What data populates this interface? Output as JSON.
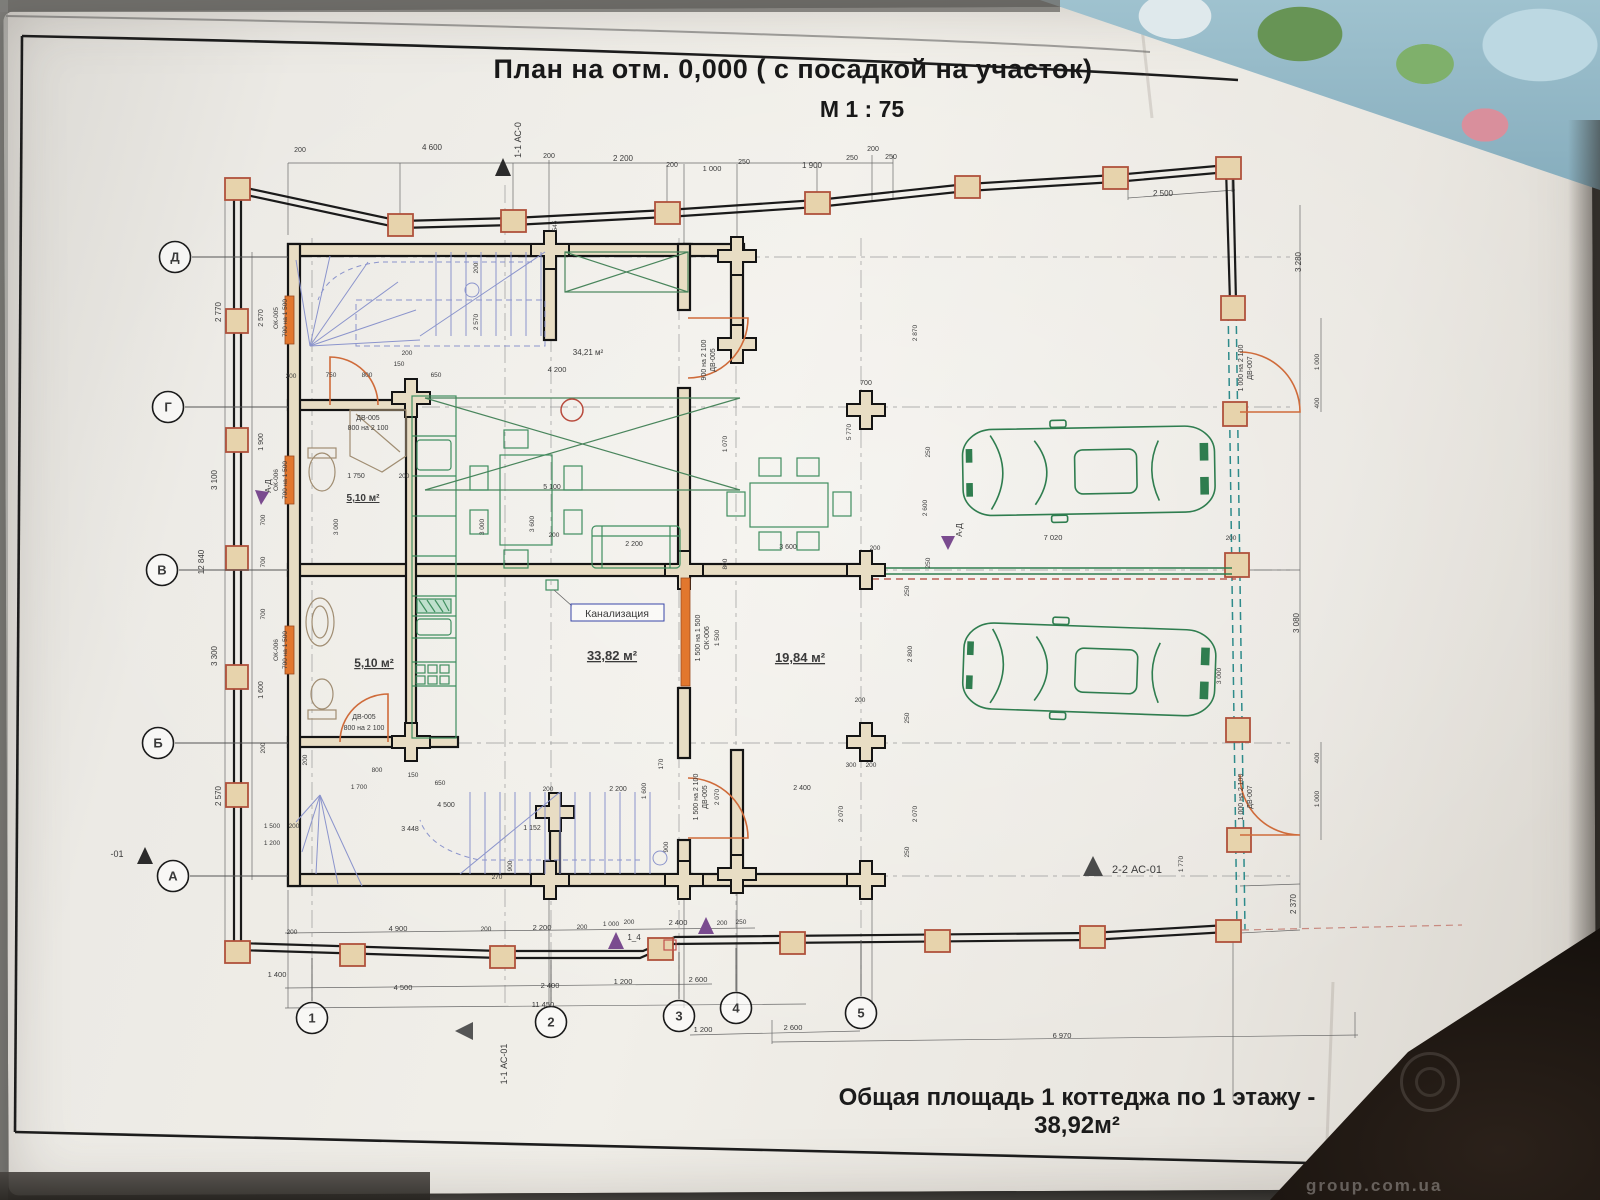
{
  "title": {
    "line1": "План на отм. 0,000 ( с посадкой на участок)",
    "line2": "М 1 : 75"
  },
  "footer": {
    "text": "Общая площадь 1 коттеджа по 1 этажу - 38,92м²"
  },
  "photo": {
    "watermark": "group.com.ua"
  },
  "colors": {
    "d": "#3a3a3a",
    "b": "#3946a8",
    "p": "#7a4b8f",
    "g": "#2f7d4f",
    "o": "#cf6b3a",
    "k": "#1a1a1a"
  },
  "grid": {
    "rows": [
      {
        "label": "Д",
        "x": 175,
        "y": 257
      },
      {
        "label": "Г",
        "x": 168,
        "y": 407
      },
      {
        "label": "В",
        "x": 162,
        "y": 570
      },
      {
        "label": "Б",
        "x": 158,
        "y": 743
      },
      {
        "label": "А",
        "x": 173,
        "y": 876
      }
    ],
    "cols": [
      {
        "label": "1",
        "x": 312,
        "y": 1018
      },
      {
        "label": "2",
        "x": 551,
        "y": 1022
      },
      {
        "label": "3",
        "x": 679,
        "y": 1016
      },
      {
        "label": "4",
        "x": 736,
        "y": 1008
      },
      {
        "label": "5",
        "x": 861,
        "y": 1013
      }
    ]
  },
  "plan": {
    "labels": [
      {
        "t": "200",
        "x": 300,
        "y": 152,
        "s": 7
      },
      {
        "t": "4 600",
        "x": 432,
        "y": 150
      },
      {
        "t": "200",
        "x": 549,
        "y": 158,
        "s": 7
      },
      {
        "t": "2 200",
        "x": 623,
        "y": 161
      },
      {
        "t": "200",
        "x": 672,
        "y": 167,
        "s": 7
      },
      {
        "t": "1 000",
        "x": 712,
        "y": 171,
        "s": 7.5
      },
      {
        "t": "250",
        "x": 744,
        "y": 164,
        "s": 7
      },
      {
        "t": "1 900",
        "x": 812,
        "y": 168
      },
      {
        "t": "250",
        "x": 852,
        "y": 160,
        "s": 7
      },
      {
        "t": "200",
        "x": 873,
        "y": 151,
        "s": 7
      },
      {
        "t": "250",
        "x": 891,
        "y": 159,
        "s": 7
      },
      {
        "t": "2 500",
        "x": 1163,
        "y": 196
      },
      {
        "t": "545",
        "x": 557,
        "y": 226,
        "r": -90,
        "s": 6.5
      },
      {
        "t": "2 770",
        "x": 221,
        "y": 312,
        "r": -90
      },
      {
        "t": "3 100",
        "x": 217,
        "y": 480,
        "r": -90
      },
      {
        "t": "12 840",
        "x": 204,
        "y": 562,
        "r": -90
      },
      {
        "t": "3 300",
        "x": 217,
        "y": 656,
        "r": -90
      },
      {
        "t": "2 570",
        "x": 221,
        "y": 796,
        "r": -90
      },
      {
        "t": "2 570",
        "x": 263,
        "y": 318,
        "r": -90,
        "s": 7
      },
      {
        "t": "1 900",
        "x": 263,
        "y": 442,
        "r": -90,
        "s": 7
      },
      {
        "t": "700",
        "x": 265,
        "y": 520,
        "r": -90,
        "s": 6.5
      },
      {
        "t": "700",
        "x": 265,
        "y": 562,
        "r": -90,
        "s": 6.5
      },
      {
        "t": "700",
        "x": 265,
        "y": 614,
        "r": -90,
        "s": 6.5
      },
      {
        "t": "1 600",
        "x": 263,
        "y": 690,
        "r": -90,
        "s": 7
      },
      {
        "t": "200",
        "x": 265,
        "y": 748,
        "r": -90,
        "s": 6.5
      },
      {
        "t": "1 500",
        "x": 272,
        "y": 828,
        "s": 6.5
      },
      {
        "t": "200",
        "x": 294,
        "y": 828,
        "s": 6.5
      },
      {
        "t": "1 200",
        "x": 272,
        "y": 845,
        "s": 6.5
      },
      {
        "t": "1 400",
        "x": 277,
        "y": 977,
        "s": 7.5
      },
      {
        "t": "ОК-005",
        "x": 278,
        "y": 318,
        "r": -90,
        "c": "b",
        "s": 6.5
      },
      {
        "t": "700 на 1 500",
        "x": 287,
        "y": 318,
        "r": -90,
        "c": "b",
        "s": 6.5
      },
      {
        "t": "ОК-006",
        "x": 278,
        "y": 480,
        "r": -90,
        "c": "b",
        "s": 6.5
      },
      {
        "t": "700 на 1 500",
        "x": 287,
        "y": 480,
        "r": -90,
        "c": "b",
        "s": 6.5
      },
      {
        "t": "ОК-006",
        "x": 278,
        "y": 650,
        "r": -90,
        "c": "b",
        "s": 6.5
      },
      {
        "t": "700 на 1 500",
        "x": 287,
        "y": 650,
        "r": -90,
        "c": "b",
        "s": 6.5
      },
      {
        "t": "ДВ-005",
        "x": 368,
        "y": 420,
        "c": "b",
        "s": 7
      },
      {
        "t": "800 на 2 100",
        "x": 368,
        "y": 430,
        "c": "b",
        "s": 7
      },
      {
        "t": "ДВ-005",
        "x": 364,
        "y": 719,
        "c": "b",
        "s": 7
      },
      {
        "t": "800 на 2 100",
        "x": 364,
        "y": 730,
        "c": "b",
        "s": 7
      },
      {
        "t": "900 на 2 100",
        "x": 706,
        "y": 360,
        "r": -90,
        "c": "b",
        "s": 7
      },
      {
        "t": "ДВ-005",
        "x": 715,
        "y": 360,
        "r": -90,
        "c": "b",
        "s": 7
      },
      {
        "t": "1 500 на 1 500",
        "x": 700,
        "y": 638,
        "r": -90,
        "c": "b",
        "s": 7
      },
      {
        "t": "ОК-006",
        "x": 709,
        "y": 638,
        "r": -90,
        "c": "b",
        "s": 7
      },
      {
        "t": "1 500",
        "x": 719,
        "y": 638,
        "r": -90,
        "s": 6.5
      },
      {
        "t": "1 500 на 2 100",
        "x": 698,
        "y": 797,
        "r": -90,
        "c": "b",
        "s": 7
      },
      {
        "t": "ДВ-005",
        "x": 707,
        "y": 797,
        "r": -90,
        "c": "b",
        "s": 7
      },
      {
        "t": "2 070",
        "x": 719,
        "y": 797,
        "r": -90,
        "s": 6.5
      },
      {
        "t": "1 000 на 2 100",
        "x": 1243,
        "y": 368,
        "r": -90,
        "c": "b",
        "s": 7
      },
      {
        "t": "ДВ-007",
        "x": 1252,
        "y": 368,
        "r": -90,
        "c": "b",
        "s": 7
      },
      {
        "t": "1 000 на 2 100",
        "x": 1243,
        "y": 797,
        "r": -90,
        "c": "b",
        "s": 7
      },
      {
        "t": "ДВ-007",
        "x": 1252,
        "y": 797,
        "r": -90,
        "c": "b",
        "s": 7
      },
      {
        "t": "5,10 м²",
        "x": 363,
        "y": 501,
        "s": 10,
        "b": 1,
        "u": 1,
        "n": "room-area-label"
      },
      {
        "t": "5,10 м²",
        "x": 374,
        "y": 667,
        "s": 12,
        "b": 1,
        "u": 1,
        "n": "room-area-label"
      },
      {
        "t": "33,82 м²",
        "x": 612,
        "y": 660,
        "s": 13,
        "b": 1,
        "u": 1,
        "n": "room-area-label"
      },
      {
        "t": "19,84 м²",
        "x": 800,
        "y": 662,
        "s": 13,
        "b": 1,
        "u": 1,
        "n": "room-area-label"
      },
      {
        "t": "34,21 м²",
        "x": 588,
        "y": 355,
        "s": 8,
        "n": "room-area-label"
      },
      {
        "t": "200",
        "x": 291,
        "y": 378,
        "s": 6.5
      },
      {
        "t": "750",
        "x": 331,
        "y": 377,
        "s": 6.5
      },
      {
        "t": "800",
        "x": 367,
        "y": 377,
        "s": 6.5
      },
      {
        "t": "150",
        "x": 399,
        "y": 366,
        "s": 6.5
      },
      {
        "t": "200",
        "x": 407,
        "y": 355,
        "s": 6.5
      },
      {
        "t": "650",
        "x": 436,
        "y": 377,
        "s": 6.5
      },
      {
        "t": "2 570",
        "x": 478,
        "y": 322,
        "r": -90,
        "s": 6.5
      },
      {
        "t": "200",
        "x": 478,
        "y": 268,
        "r": -90,
        "s": 6.5
      },
      {
        "t": "4 200",
        "x": 557,
        "y": 372,
        "s": 7.5
      },
      {
        "t": "1 750",
        "x": 356,
        "y": 478,
        "s": 7
      },
      {
        "t": "200",
        "x": 404,
        "y": 478,
        "s": 6.5
      },
      {
        "t": "3 000",
        "x": 338,
        "y": 527,
        "r": -90,
        "s": 6.5
      },
      {
        "t": "3 000",
        "x": 484,
        "y": 527,
        "r": -90,
        "s": 6.5
      },
      {
        "t": "5 100",
        "x": 552,
        "y": 489,
        "s": 7
      },
      {
        "t": "3 600",
        "x": 534,
        "y": 524,
        "r": -90,
        "s": 6.5
      },
      {
        "t": "200",
        "x": 554,
        "y": 537,
        "s": 6.5
      },
      {
        "t": "2 200",
        "x": 634,
        "y": 546,
        "s": 7
      },
      {
        "t": "5 770",
        "x": 851,
        "y": 432,
        "r": -90,
        "s": 6.5
      },
      {
        "t": "1 070",
        "x": 727,
        "y": 444,
        "r": -90,
        "s": 6.5
      },
      {
        "t": "3 600",
        "x": 788,
        "y": 549,
        "s": 7
      },
      {
        "t": "200",
        "x": 875,
        "y": 550,
        "s": 6.5
      },
      {
        "t": "800",
        "x": 727,
        "y": 564,
        "r": -90,
        "s": 6.5
      },
      {
        "t": "250",
        "x": 930,
        "y": 452,
        "r": -90,
        "s": 6.5
      },
      {
        "t": "2 600",
        "x": 927,
        "y": 508,
        "r": -90,
        "s": 6.5
      },
      {
        "t": "250",
        "x": 930,
        "y": 563,
        "r": -90,
        "s": 6.5
      },
      {
        "t": "700",
        "x": 866,
        "y": 385,
        "s": 7
      },
      {
        "t": "2 870",
        "x": 917,
        "y": 333,
        "r": -90,
        "s": 6.5
      },
      {
        "t": "200",
        "x": 860,
        "y": 702,
        "s": 6.5
      },
      {
        "t": "7 020",
        "x": 1053,
        "y": 540,
        "s": 7.5
      },
      {
        "t": "200",
        "x": 1231,
        "y": 540,
        "s": 6.5
      },
      {
        "t": "250",
        "x": 909,
        "y": 591,
        "r": -90,
        "s": 6.5
      },
      {
        "t": "2 800",
        "x": 912,
        "y": 654,
        "r": -90,
        "s": 6.5
      },
      {
        "t": "250",
        "x": 909,
        "y": 718,
        "r": -90,
        "s": 6.5
      },
      {
        "t": "3 000",
        "x": 1221,
        "y": 676,
        "r": -90,
        "s": 6.5
      },
      {
        "t": "1 770",
        "x": 1183,
        "y": 864,
        "r": -90,
        "s": 6.5
      },
      {
        "t": "300",
        "x": 851,
        "y": 767,
        "s": 6.5
      },
      {
        "t": "200",
        "x": 871,
        "y": 767,
        "s": 6.5
      },
      {
        "t": "2 400",
        "x": 802,
        "y": 790,
        "s": 7
      },
      {
        "t": "2 070",
        "x": 843,
        "y": 814,
        "r": -90,
        "s": 6.5
      },
      {
        "t": "2 070",
        "x": 917,
        "y": 814,
        "r": -90,
        "s": 6.5
      },
      {
        "t": "250",
        "x": 909,
        "y": 852,
        "r": -90,
        "s": 6.5
      },
      {
        "t": "3 280",
        "x": 1301,
        "y": 262,
        "r": -90
      },
      {
        "t": "1 000",
        "x": 1319,
        "y": 362,
        "r": -90,
        "s": 6.5
      },
      {
        "t": "400",
        "x": 1319,
        "y": 403,
        "r": -90,
        "s": 6.5
      },
      {
        "t": "3 080",
        "x": 1299,
        "y": 623,
        "r": -90
      },
      {
        "t": "400",
        "x": 1319,
        "y": 758,
        "r": -90,
        "s": 6.5
      },
      {
        "t": "1 000",
        "x": 1319,
        "y": 799,
        "r": -90,
        "s": 6.5
      },
      {
        "t": "2 370",
        "x": 1296,
        "y": 904,
        "r": -90
      },
      {
        "t": "200",
        "x": 307,
        "y": 760,
        "r": -90,
        "s": 6.5
      },
      {
        "t": "1 700",
        "x": 359,
        "y": 789,
        "s": 6.5
      },
      {
        "t": "800",
        "x": 377,
        "y": 772,
        "s": 6.5
      },
      {
        "t": "150",
        "x": 413,
        "y": 777,
        "s": 6.5
      },
      {
        "t": "650",
        "x": 440,
        "y": 785,
        "s": 6.5
      },
      {
        "t": "4 500",
        "x": 446,
        "y": 807,
        "s": 7
      },
      {
        "t": "3 448",
        "x": 410,
        "y": 831,
        "s": 7
      },
      {
        "t": "1 152",
        "x": 532,
        "y": 830,
        "s": 7
      },
      {
        "t": "270",
        "x": 497,
        "y": 879,
        "s": 6.5
      },
      {
        "t": "900",
        "x": 512,
        "y": 866,
        "r": -90,
        "s": 6.5
      },
      {
        "t": "200",
        "x": 548,
        "y": 791,
        "s": 6.5
      },
      {
        "t": "2 200",
        "x": 618,
        "y": 791,
        "s": 7
      },
      {
        "t": "1 600",
        "x": 646,
        "y": 791,
        "r": -90,
        "s": 6.5
      },
      {
        "t": "170",
        "x": 663,
        "y": 764,
        "r": -90,
        "s": 6.5
      },
      {
        "t": "900",
        "x": 668,
        "y": 847,
        "r": -90,
        "s": 6.5
      },
      {
        "t": "200",
        "x": 292,
        "y": 934,
        "s": 6.5
      },
      {
        "t": "4 900",
        "x": 398,
        "y": 931,
        "s": 7.5
      },
      {
        "t": "200",
        "x": 486,
        "y": 931,
        "s": 6.5
      },
      {
        "t": "2 200",
        "x": 542,
        "y": 930,
        "s": 7.5
      },
      {
        "t": "200",
        "x": 582,
        "y": 929,
        "s": 6.5
      },
      {
        "t": "1 000",
        "x": 611,
        "y": 926,
        "s": 6.5
      },
      {
        "t": "200",
        "x": 629,
        "y": 924,
        "s": 6.5
      },
      {
        "t": "2 400",
        "x": 678,
        "y": 925,
        "s": 7.5
      },
      {
        "t": "200",
        "x": 722,
        "y": 925,
        "s": 6.5
      },
      {
        "t": "250",
        "x": 741,
        "y": 924,
        "s": 6.5
      },
      {
        "t": "4 500",
        "x": 403,
        "y": 990,
        "s": 7.5
      },
      {
        "t": "2 400",
        "x": 550,
        "y": 988,
        "s": 7.5
      },
      {
        "t": "1 200",
        "x": 623,
        "y": 984,
        "s": 7.5
      },
      {
        "t": "2 600",
        "x": 698,
        "y": 982,
        "s": 7.5
      },
      {
        "t": "11 450",
        "x": 543,
        "y": 1007,
        "s": 7.5
      },
      {
        "t": "1 200",
        "x": 703,
        "y": 1032,
        "s": 7.5
      },
      {
        "t": "2 600",
        "x": 793,
        "y": 1030,
        "s": 7.5
      },
      {
        "t": "6 970",
        "x": 1062,
        "y": 1038,
        "s": 7.5
      },
      {
        "t": "1-1 АС-0",
        "x": 521,
        "y": 140,
        "r": -90,
        "s": 9,
        "n": "section-mark-label"
      },
      {
        "t": "1-1 АС-01",
        "x": 507,
        "y": 1064,
        "r": -90,
        "s": 9,
        "n": "section-mark-label"
      },
      {
        "t": "2-2 АС-01",
        "x": 1137,
        "y": 873,
        "s": 11,
        "n": "section-mark-label"
      },
      {
        "t": "А-Д",
        "x": 962,
        "y": 530,
        "r": -90,
        "s": 8,
        "c": "p",
        "n": "section-mark-label"
      },
      {
        "t": "А-Д",
        "x": 271,
        "y": 486,
        "r": -90,
        "s": 8,
        "c": "p",
        "n": "section-mark-label"
      },
      {
        "t": "1_4",
        "x": 634,
        "y": 940,
        "s": 8,
        "c": "p",
        "n": "section-mark-label"
      },
      {
        "t": "-01",
        "x": 117,
        "y": 857,
        "s": 9,
        "n": "section-mark-label"
      },
      {
        "t": "Канализация",
        "x": 617,
        "y": 617,
        "c": "b",
        "s": 10.5,
        "n": "sewer-label"
      }
    ]
  }
}
